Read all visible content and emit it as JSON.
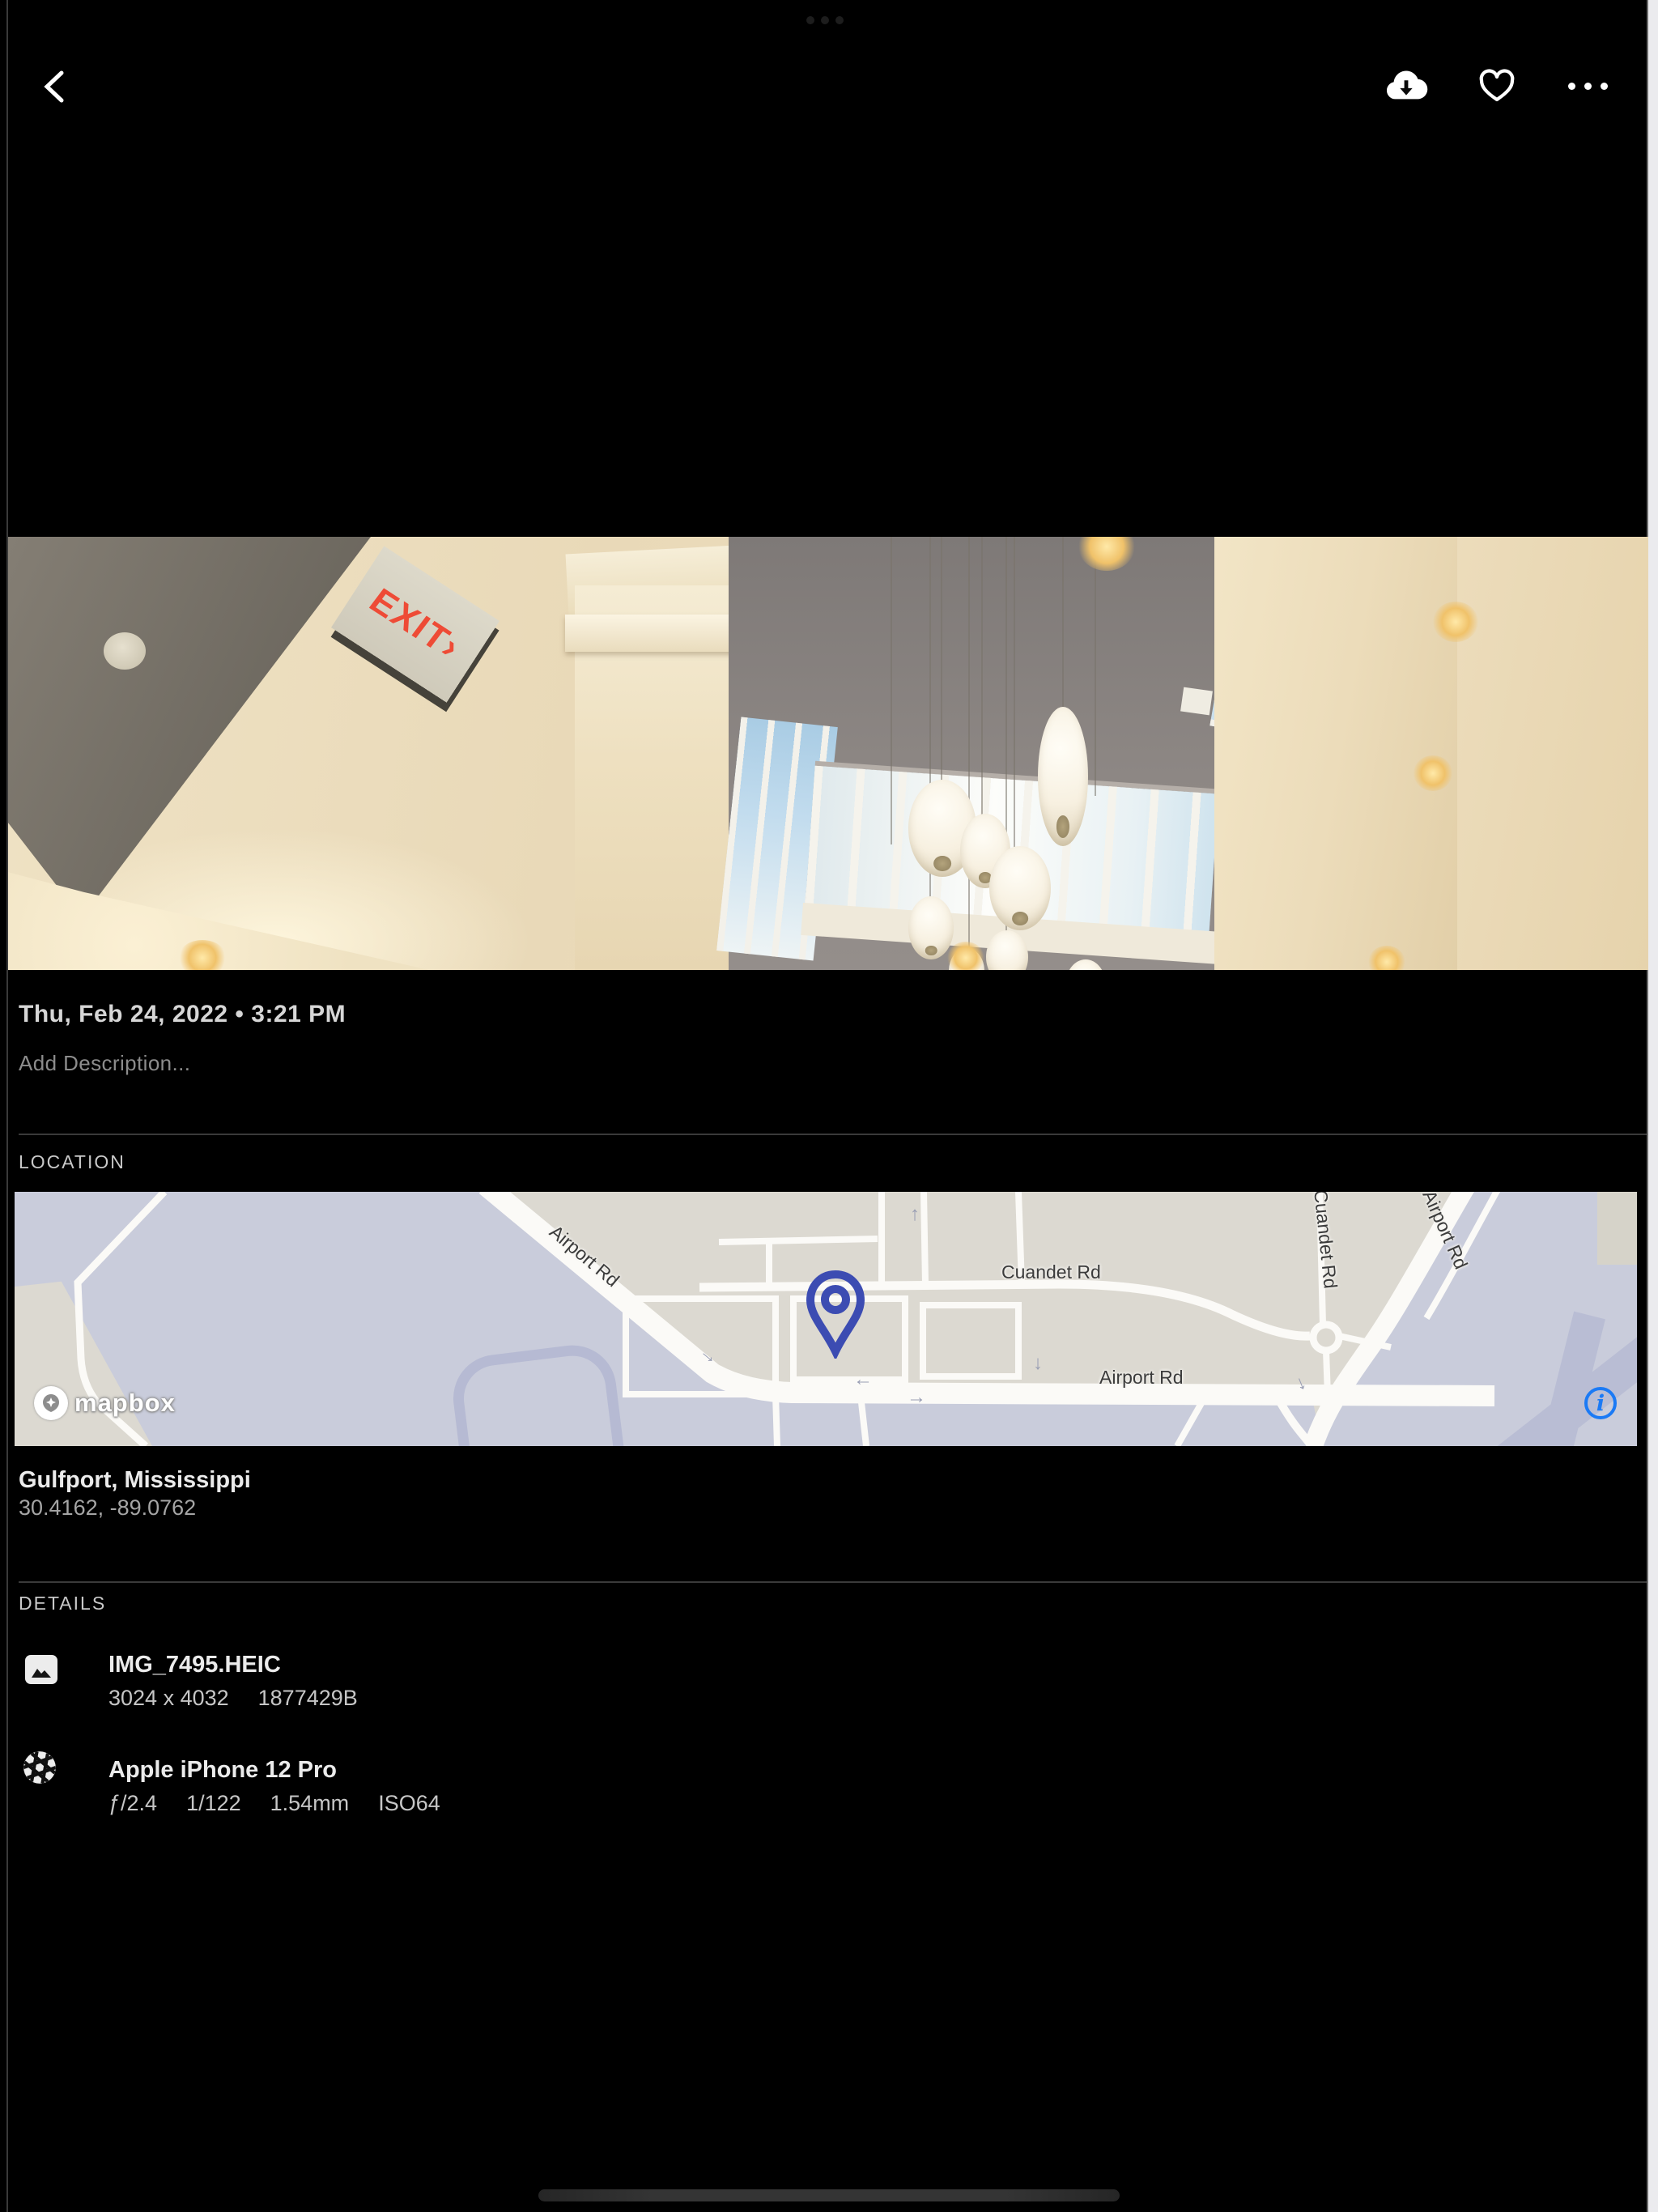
{
  "window": {
    "multitask_handle": "slide-over-grab-handle"
  },
  "toolbar": {
    "back_icon": "chevron-left",
    "download_icon": "cloud-download",
    "favorite_icon": "heart-outline",
    "more_icon": "ellipsis"
  },
  "photo": {
    "exit_sign_text": "EXIT›"
  },
  "meta": {
    "date_line": "Thu, Feb 24, 2022 • 3:21 PM",
    "description_placeholder": "Add Description..."
  },
  "location": {
    "section_label": "LOCATION",
    "place": "Gulfport, Mississippi",
    "coordinates": "30.4162, -89.0762",
    "map": {
      "attribution": "mapbox",
      "info_glyph": "i",
      "road_labels": {
        "airport_rd_diagonal": "Airport Rd",
        "cuandet_rd": "Cuandet Rd",
        "airport_rd_horizontal": "Airport Rd",
        "airport_rd_right_edge": "Airport Rd",
        "cuandet_rd_vertical": "Cuandet Rd"
      },
      "arrows": [
        "→",
        "←",
        "→",
        "→",
        "↓",
        "↑"
      ]
    }
  },
  "details": {
    "section_label": "DETAILS",
    "rows": [
      {
        "icon": "image-file-icon",
        "title": "IMG_7495.HEIC",
        "tokens": [
          "3024 x 4032",
          "1877429B"
        ]
      },
      {
        "icon": "aperture-icon",
        "title": "Apple iPhone 12 Pro",
        "tokens": [
          "ƒ/2.4",
          "1/122",
          "1.54mm",
          "ISO64"
        ]
      }
    ]
  }
}
